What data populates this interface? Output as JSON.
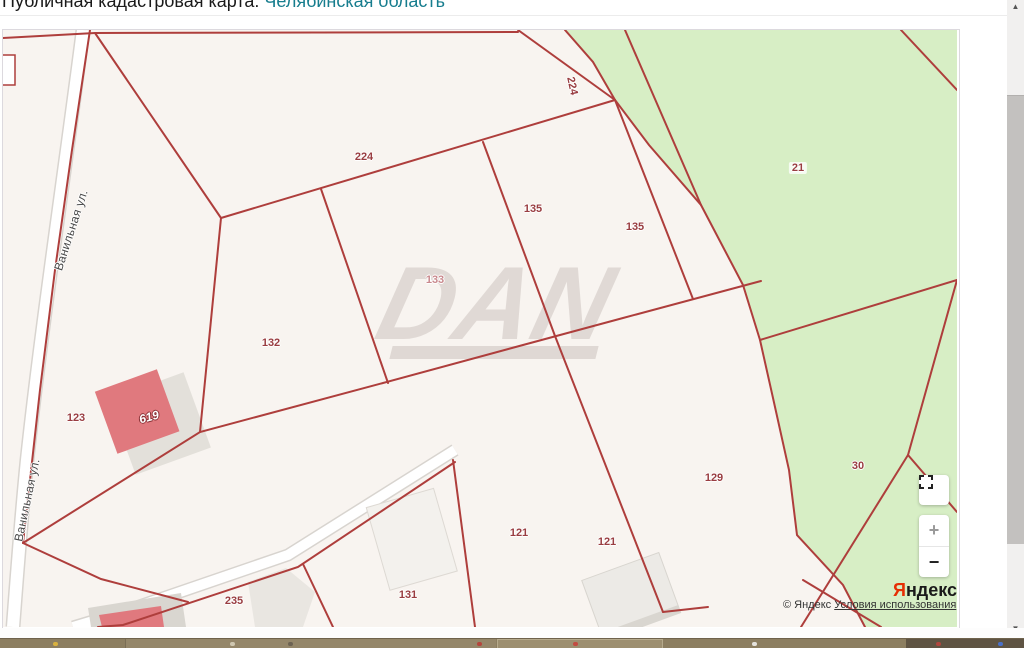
{
  "page": {
    "title_prefix": "Публичная кадастровая карта: ",
    "title_region": "Челябинская область"
  },
  "map": {
    "watermark": "DAN",
    "street_labels": [
      {
        "text": "Ванильная ул."
      },
      {
        "text": "Ванильная ул."
      }
    ],
    "parcel_labels": [
      {
        "text": "224"
      },
      {
        "text": "224"
      },
      {
        "text": "135"
      },
      {
        "text": "135"
      },
      {
        "text": "21"
      },
      {
        "text": "133"
      },
      {
        "text": "132"
      },
      {
        "text": "123"
      },
      {
        "text": "619"
      },
      {
        "text": "129"
      },
      {
        "text": "30"
      },
      {
        "text": "121"
      },
      {
        "text": "121"
      },
      {
        "text": "131"
      },
      {
        "text": "235"
      }
    ],
    "colors": {
      "land": "#f8f4f0",
      "forest": "#d7eec5",
      "boundary_red": "#ae3e3c",
      "building_red": "#e0797e",
      "label_red": "#993d41"
    }
  },
  "controls": {
    "zoom_in_label": "+",
    "zoom_out_label": "−"
  },
  "attribution": {
    "logo_first": "Я",
    "logo_rest": "ндекс",
    "copyright": "© Яндекс",
    "terms_link": "Условия использования"
  },
  "scrollbar": {
    "up_arrow": "▲",
    "down_arrow": "▼"
  }
}
